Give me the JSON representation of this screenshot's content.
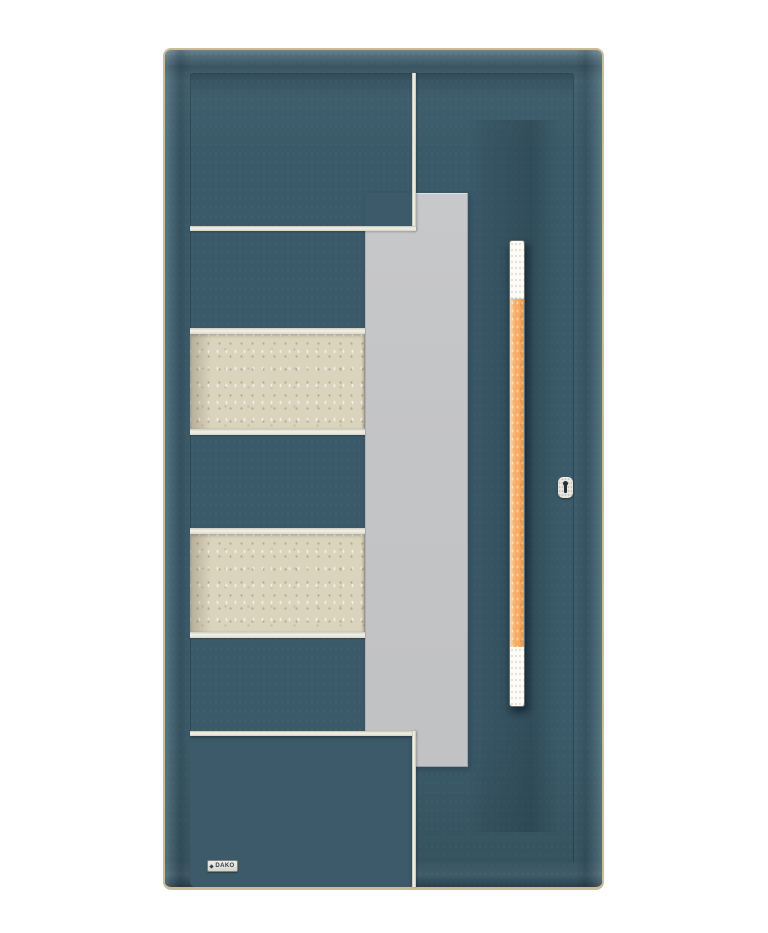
{
  "subject": "modern exterior front door product photo",
  "brand": {
    "label": "DAKO"
  },
  "door": {
    "leaf_color_name": "petrol blue",
    "handle_grip_color_name": "orange wood",
    "glass_panel": "vertical frosted glass strip",
    "stone_inserts_count": "2",
    "inlay_finish": "stainless steel lines"
  },
  "colors": {
    "background": "#ffffff",
    "frame-tan": "#c9bc9b",
    "door-teal": "#3d5c6c",
    "bevel-light": "#5b7a89",
    "silver-bright": "#f4f2e8",
    "silver-shade": "#b8b5a6",
    "glass-gray": "#c4c5c7",
    "glass-edge": "#9fa3a6",
    "stone-beige": "#dbd4bd",
    "strip-white": "#f2f1ea",
    "handle-orange": "#f8ac62",
    "handle-white": "#fdfcf6",
    "lock-plate": "#e9e7df",
    "keyhole-dark": "#232f39",
    "plaque-bg": "#e5e4dc",
    "plaque-text": "#2f3f4a"
  }
}
